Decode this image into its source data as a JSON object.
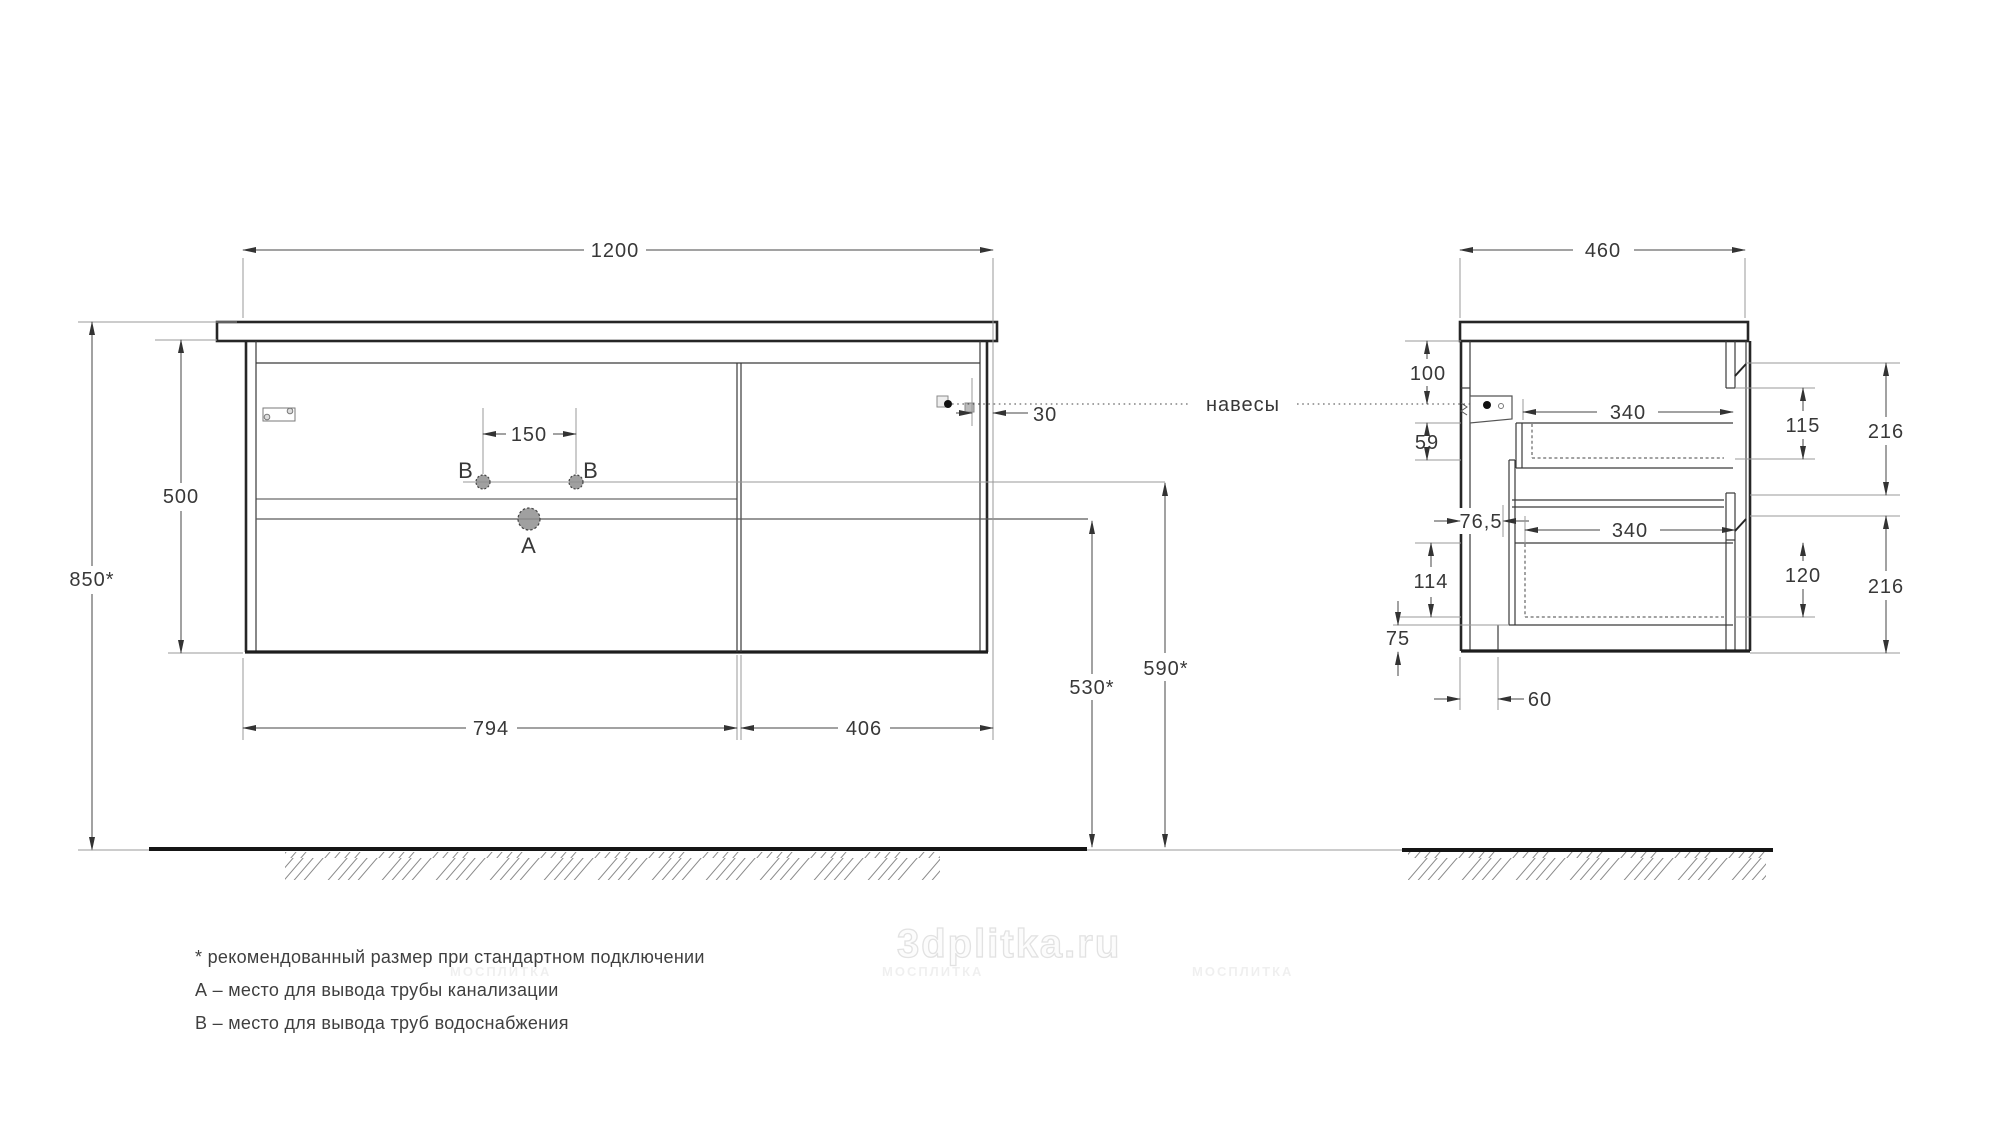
{
  "front_view": {
    "width_label": "1200",
    "left_section_width": "794",
    "right_section_width": "406",
    "cabinet_height": "500",
    "mount_height": "850*",
    "faucet_hole_spacing": "150",
    "hanger_inset": "30",
    "drain_height": "530*",
    "supply_height": "590*",
    "label_a": "A",
    "label_b": "B"
  },
  "side_view": {
    "depth": "460",
    "hanger_top_offset": "100",
    "dim_59": "59",
    "drawer_depth_top": "340",
    "drawer_depth_bottom": "340",
    "dim_115": "115",
    "dim_216_top": "216",
    "dim_216_bottom": "216",
    "dim_76_5": "76,5",
    "dim_114": "114",
    "dim_120": "120",
    "dim_75": "75",
    "dim_60": "60"
  },
  "annotations": {
    "hangers_label": "навесы"
  },
  "footnotes": [
    "* рекомендованный размер при стандартном подключении",
    "А – место для вывода трубы канализации",
    "В – место для вывода труб водоснабжения"
  ],
  "watermark": {
    "main": "3dplitka.ru",
    "brand": "МОСПЛИТКА"
  },
  "colors": {
    "structure": "#262626",
    "dimension": "#444444",
    "reference": "#999999",
    "hole_fill": "#8f8f8f"
  }
}
